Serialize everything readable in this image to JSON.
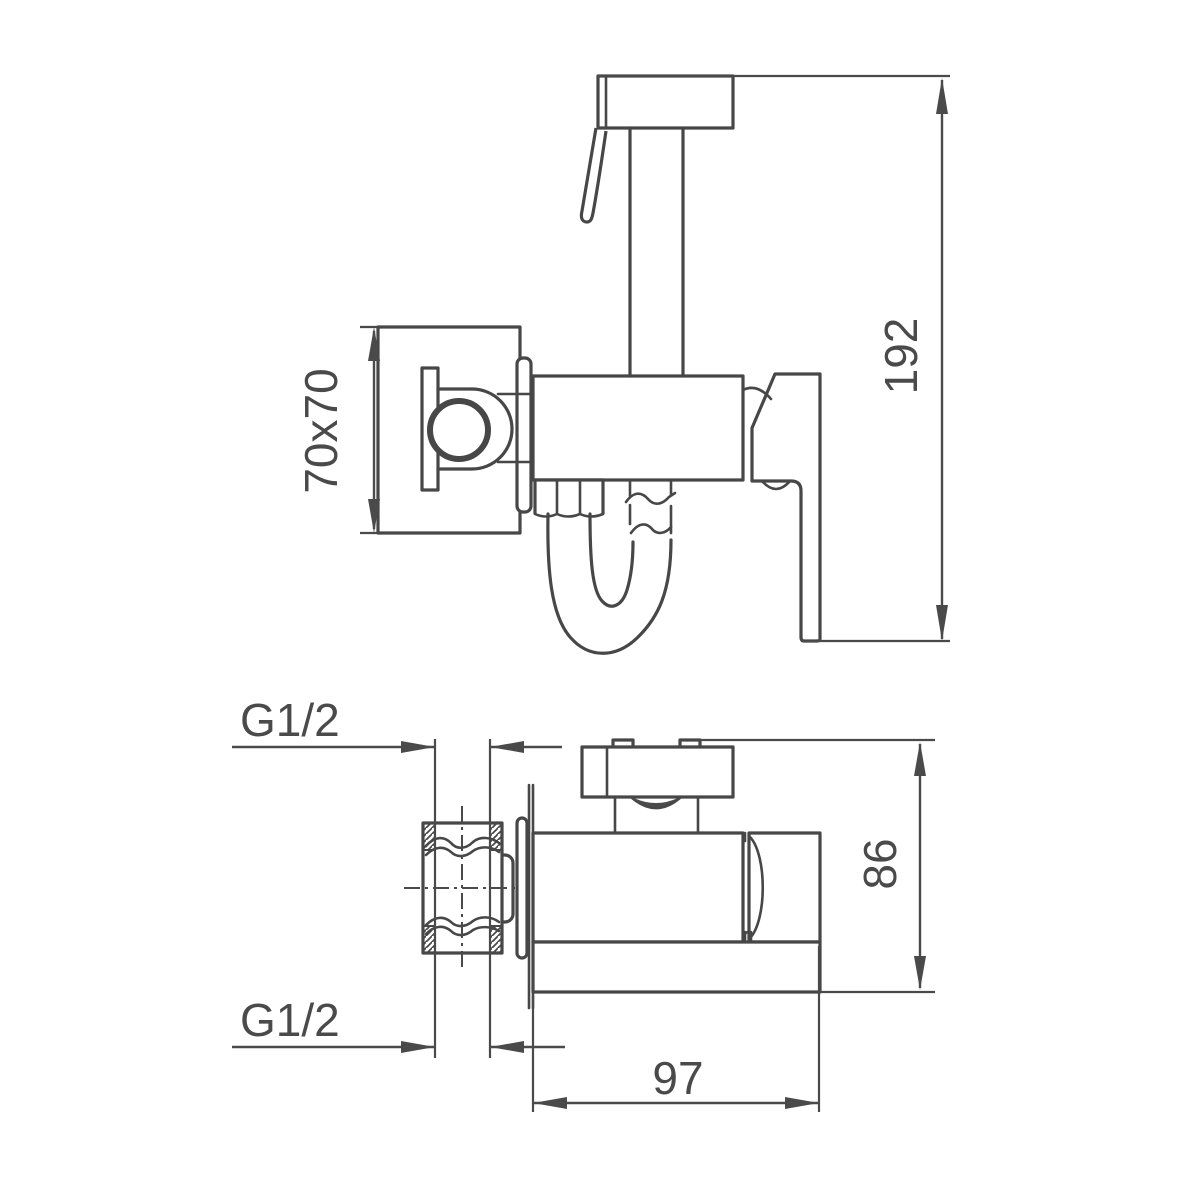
{
  "page": {
    "background_color": "#ffffff",
    "line_color": "#474747",
    "text_color": "#4a4a4a"
  },
  "drawing": {
    "type": "technical-dimension-drawing",
    "subject": "wall-mounted bidet hand shower faucet, front view and bottom view",
    "front_view": {
      "plate_dimension_label": "70x70",
      "height_dimension_label": "192"
    },
    "bottom_view": {
      "inlet_thread_label": "G1/2",
      "outlet_thread_label": "G1/2",
      "height_dimension_label": "86",
      "depth_dimension_label": "97"
    }
  }
}
